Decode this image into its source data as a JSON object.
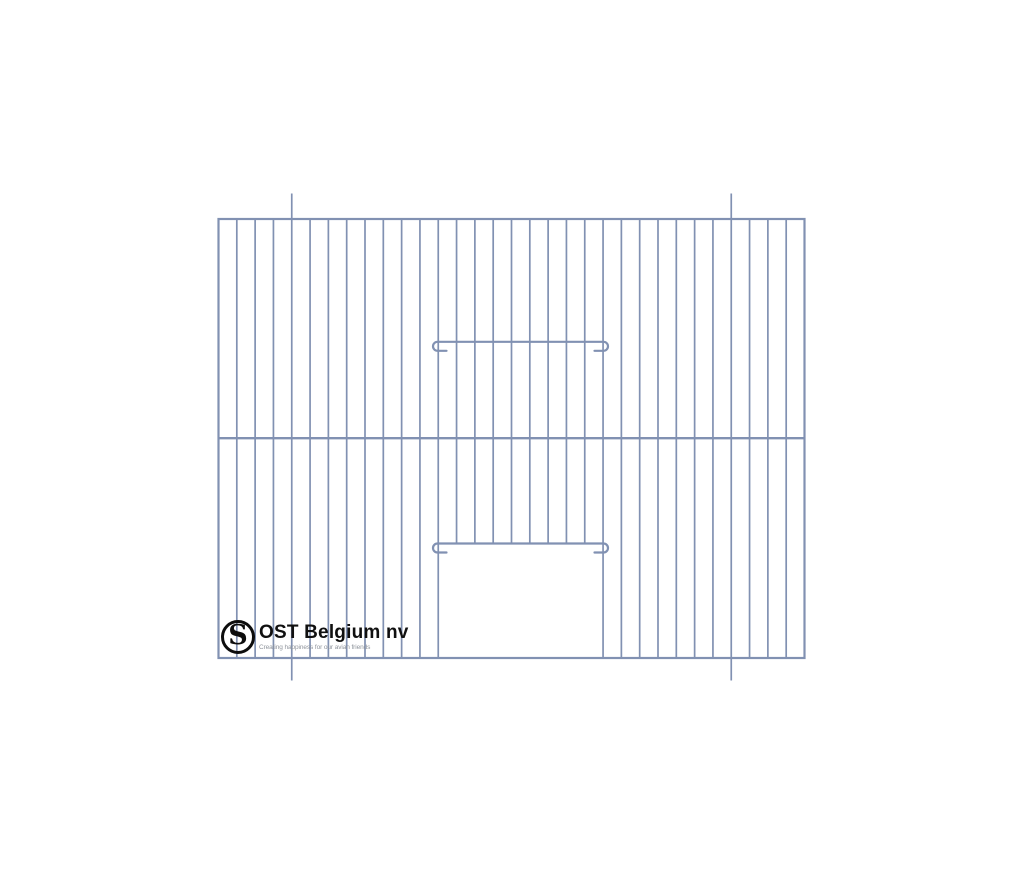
{
  "canvas": {
    "width": 1024,
    "height": 878,
    "background": "#ffffff"
  },
  "brand": {
    "monogram": "S",
    "name": "OST Belgium nv",
    "tagline": "Creating happiness for our avian friends",
    "name_color": "#101010",
    "tagline_color": "#8f949c",
    "monogram_color": "#0d0d0d"
  },
  "drawing": {
    "subject": "wire cage front panel with centre wire, two hooked latch wires and a bottom door opening",
    "stroke_color": "#8191b2",
    "frame": {
      "x": 218.5,
      "y": 219,
      "width": 586,
      "height": 439
    },
    "gap_count": 32,
    "bar_width": 1.7,
    "frame_width": 2.2,
    "mid_wire_y": 438.2,
    "mid_wire_width": 2.4,
    "wire_width": 2.2,
    "door": {
      "left_bar_index": 12,
      "right_bar_index": 21,
      "opening_top_y": 543.5
    },
    "hook_wires": [
      {
        "y": 341.8,
        "x1": 437.5,
        "x2": 603.5,
        "hook_radius": 4.5,
        "stub_length": 9
      },
      {
        "y": 543.5,
        "x1": 437.5,
        "x2": 603.5,
        "hook_radius": 4.5,
        "stub_length": 9
      }
    ],
    "tick_marks": {
      "bar_indices": [
        4,
        28
      ],
      "top_y": 193.5,
      "bottom_y": 680.5
    }
  }
}
